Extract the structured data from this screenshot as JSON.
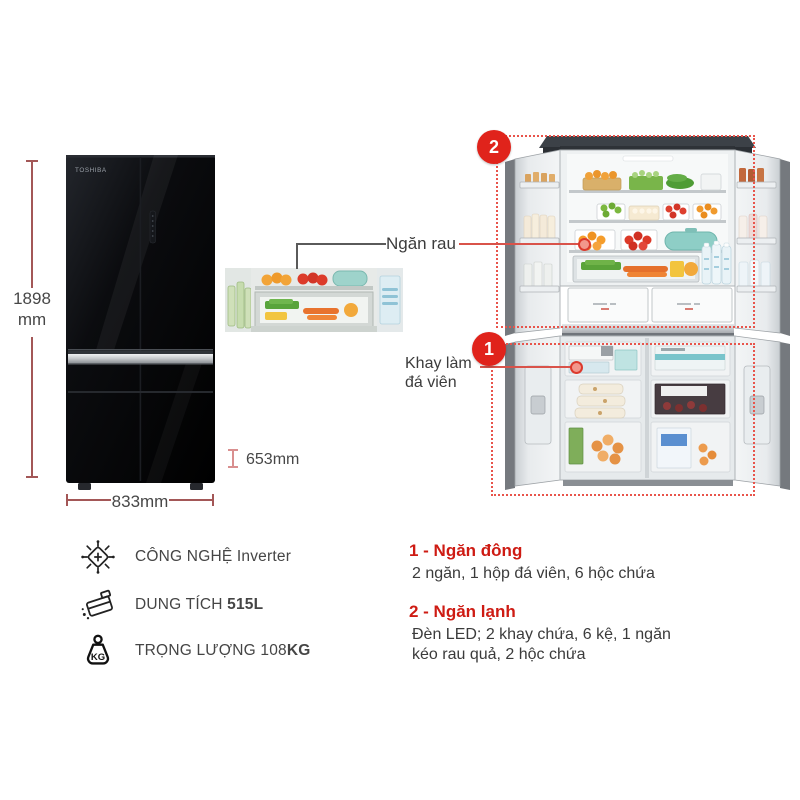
{
  "product": {
    "brand": "TOSHIBA"
  },
  "dimensions": {
    "height_value": "1898",
    "height_unit": "mm",
    "width": "833mm",
    "depth": "653mm"
  },
  "callouts": {
    "vegetable_drawer": "Ngăn rau",
    "ice_tray_line1": "Khay làm",
    "ice_tray_line2": "đá viên"
  },
  "markers": {
    "fridge": "2",
    "freezer": "1"
  },
  "specs": [
    {
      "icon": "inverter-circuit-icon",
      "label": "CÔNG NGHỆ",
      "value": "Inverter"
    },
    {
      "icon": "capacity-box-icon",
      "label": "DUNG TÍCH",
      "value": "515L"
    },
    {
      "icon": "weight-kg-icon",
      "label": "TRỌNG LƯỢNG",
      "value": "108",
      "unit": "KG",
      "icon_text": "KG"
    }
  ],
  "legend": [
    {
      "title": "1 - Ngăn đông",
      "desc": "2 ngăn, 1 hộp đá viên, 6 hộc chứa"
    },
    {
      "title": "2 - Ngăn lạnh",
      "desc": "Đèn LED; 2 khay chứa, 6 kệ, 1 ngăn kéo rau quả, 2 hộc chứa"
    }
  ],
  "colors": {
    "accent_red": "#e0231b",
    "dashed_outline": "#e8544b",
    "dimension_line": "#a35757",
    "depth_mark": "#d98f8f",
    "text_dark": "#474747",
    "legend_title_red": "#ce1b13"
  }
}
